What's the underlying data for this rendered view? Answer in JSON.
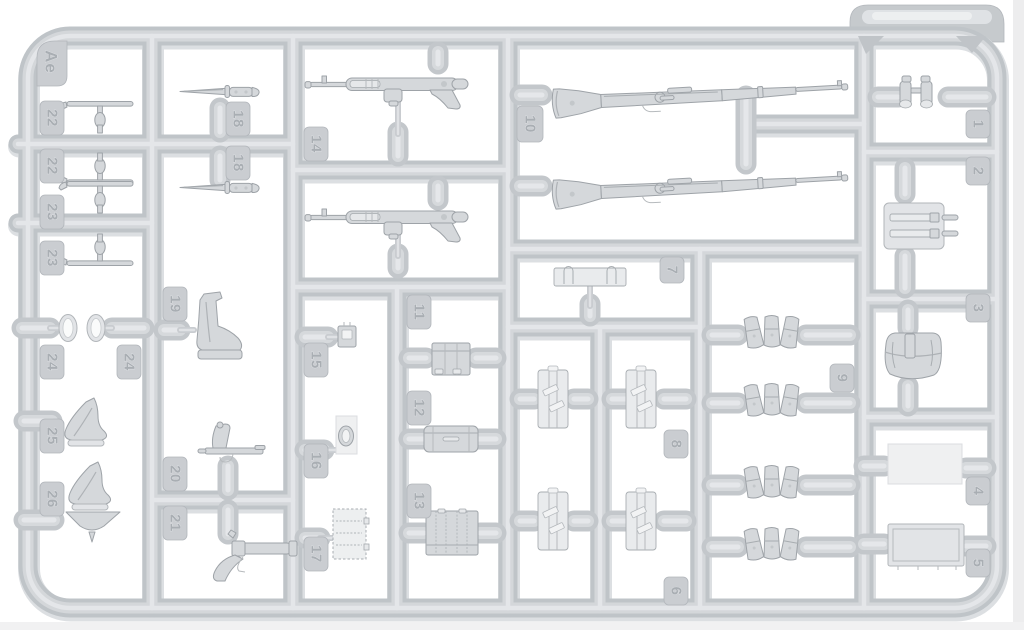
{
  "sprue": {
    "corner_tag": "Ae",
    "tabs": [
      "22",
      "22",
      "23",
      "23",
      "24",
      "24",
      "25",
      "26",
      "18",
      "18",
      "19",
      "20",
      "21",
      "14",
      "15",
      "16",
      "17",
      "11",
      "12",
      "13",
      "10",
      "7",
      "8",
      "6",
      "9",
      "1",
      "2",
      "3",
      "4",
      "5"
    ],
    "parts": [
      {
        "number": "1",
        "name": "binoculars",
        "count": 1
      },
      {
        "number": "2",
        "name": "map-case",
        "count": 1
      },
      {
        "number": "3",
        "name": "bread-bag",
        "count": 1
      },
      {
        "number": "4",
        "name": "flat-panel",
        "count": 1
      },
      {
        "number": "5",
        "name": "flat-panel",
        "count": 1
      },
      {
        "number": "6",
        "name": "equipment-panel",
        "count": 2
      },
      {
        "number": "7",
        "name": "mounting-bracket",
        "count": 1
      },
      {
        "number": "8",
        "name": "equipment-panel",
        "count": 2
      },
      {
        "number": "9",
        "name": "triple-ammo-pouch",
        "count": 4
      },
      {
        "number": "10",
        "name": "kar98k-rifle",
        "count": 2
      },
      {
        "number": "11",
        "name": "pouch-block",
        "count": 1
      },
      {
        "number": "12",
        "name": "container-cylinder",
        "count": 1
      },
      {
        "number": "13",
        "name": "pouch-block-wide",
        "count": 1
      },
      {
        "number": "14",
        "name": "mp40-smg",
        "count": 2
      },
      {
        "number": "15",
        "name": "buckle",
        "count": 1
      },
      {
        "number": "16",
        "name": "oval-lid",
        "count": 1
      },
      {
        "number": "17",
        "name": "flat-plate",
        "count": 1
      },
      {
        "number": "18",
        "name": "bayonet",
        "count": 2
      },
      {
        "number": "19",
        "name": "holster-body",
        "count": 1
      },
      {
        "number": "20",
        "name": "pistol",
        "count": 1
      },
      {
        "number": "21",
        "name": "flare-pistol",
        "count": 1
      },
      {
        "number": "22",
        "name": "t-handle",
        "count": 2
      },
      {
        "number": "23",
        "name": "t-handle",
        "count": 2
      },
      {
        "number": "24",
        "name": "lens",
        "count": 2
      },
      {
        "number": "25",
        "name": "holster-flap",
        "count": 1
      },
      {
        "number": "26",
        "name": "holster-with-funnel",
        "count": 1
      }
    ],
    "colors": {
      "background": "#ffffff",
      "plastic": "#c9cdd1",
      "plastic_highlight": "#e4e6e9",
      "plastic_shadow": "#b6babe",
      "part_fill": "#d5d8db",
      "panel_fill": "#eff0f1",
      "label_text": "#a9aeb3"
    }
  }
}
